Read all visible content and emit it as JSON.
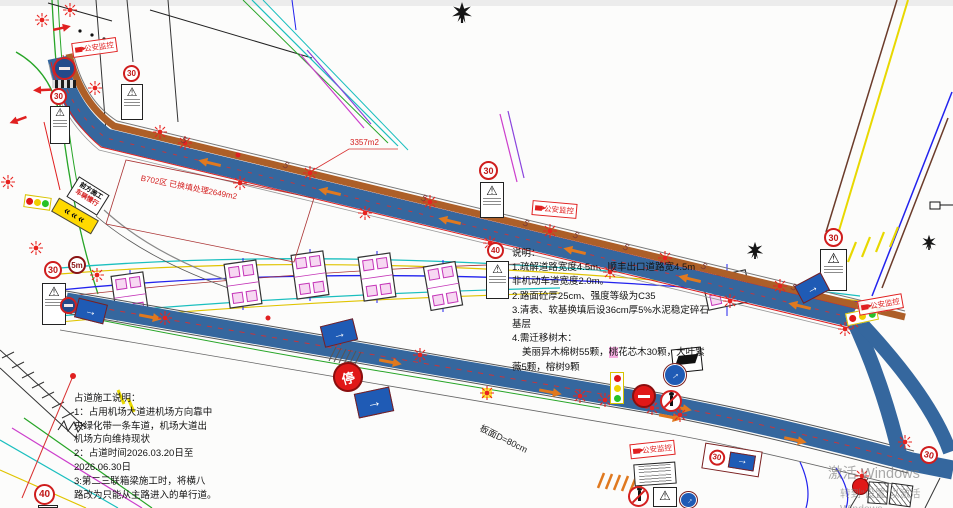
{
  "annotations": {
    "area_total": "3357m2",
    "backfill": "B702区 已换填处理2649m2",
    "slab_note": "板面D=80cm"
  },
  "notes": {
    "title": "说明：",
    "lines": [
      "1.疏解道路宽度4.5m、顺丰出口道路宽4.5m",
      "非机动车道宽度2.0m。",
      "2.路面砼厚25cm、强度等级为C35",
      "3.清表、软基换填后设36cm厚5%水泥稳定碎石",
      "基层",
      "4.需迁移树木："
    ],
    "tree_line": {
      "pre": "美丽异木棉树55颗，",
      "highlight": "桃",
      "post": "花芯木30颗，大叶紫"
    },
    "last_line": "薇5颗，榕树9颗"
  },
  "occupation_notes": {
    "title": "占道施工说明：",
    "lines": [
      "1：占用机场大道进机场方向靠中",
      "央绿化带一条车道，机场大道出",
      "机场方向维持现状",
      "2：占道时间2026.03.20日至",
      "2026.06.30日",
      "3:第二三联箱梁施工时，将横八",
      "路改为只能从主路进入的单行道。"
    ]
  },
  "signs": {
    "speed_30": "30",
    "speed_40": "40",
    "clearance_5m": "5m",
    "stop": "停",
    "monitor_label": "公安监控",
    "construction_ahead": "前方施工",
    "slow_down": "车辆慢行"
  },
  "icons": {
    "warning_triangle": "⚠",
    "arrow_right": "→",
    "chevrons": "«««",
    "lamp_glyph": "5"
  },
  "watermark": {
    "line1": "激活 Windows",
    "line2": "转到“设置”以激活 Windows。"
  },
  "colors": {
    "road_blue": "#35679e",
    "stripe_brown": "#ad5f28",
    "warning_red": "#e02020",
    "bridge_magenta": "#c435b8"
  }
}
